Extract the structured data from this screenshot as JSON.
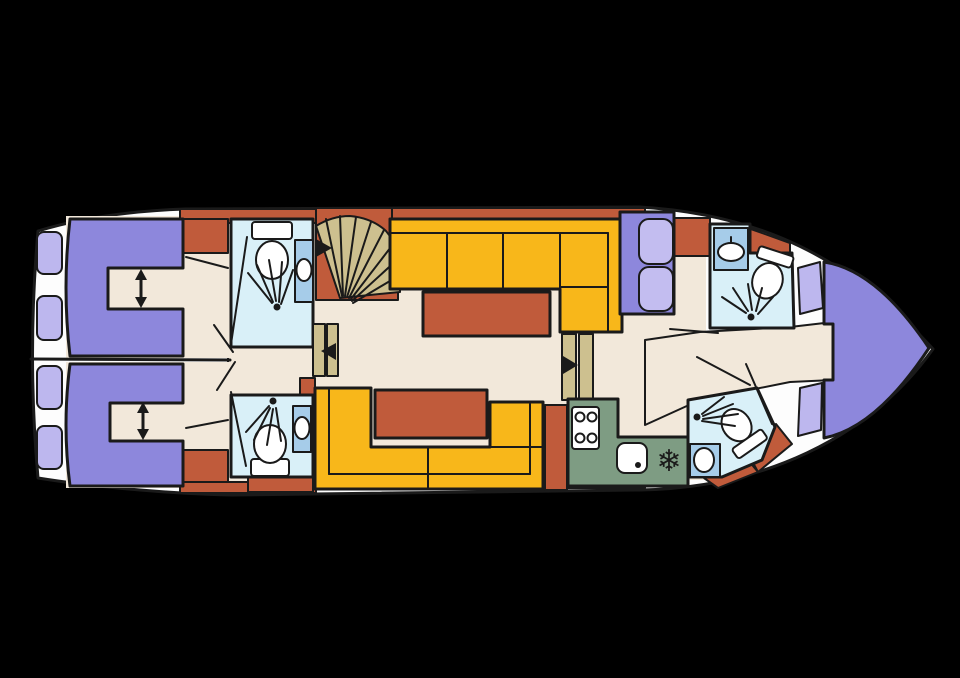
{
  "title": "yacht-deck-floor-plan",
  "colors": {
    "background": "#000000",
    "hull": "#fdfdfd",
    "outline": "#1a1a1a",
    "floor": "#f2e8da",
    "wall_cabinet": "#c05b3b",
    "sofa": "#f8b71a",
    "bed": "#8d87dc",
    "cushion": "#c3bdf0",
    "window": "#bdb7ee",
    "bathroom": "#d9f0f8",
    "sink_unit": "#a6cce9",
    "galley": "#7e9c83",
    "steps": "#cdc08f",
    "fixture": "#ffffff",
    "icon": "#1a1a1a"
  },
  "icons": {
    "freezer_glyph": "❄"
  },
  "features": [
    "aft-cabin-port",
    "aft-cabin-starboard",
    "aft-berth",
    "berth-length-arrow",
    "aft-head-port",
    "aft-head-starboard",
    "toilet",
    "shower-spray",
    "washbasin",
    "companionway-fan-stairs",
    "entry-arrow",
    "salon-l-sofa",
    "salon-table",
    "dinette-u-sofa",
    "dinette-table",
    "midship-steps",
    "galley",
    "stove-4-burner",
    "galley-sink",
    "freezer",
    "forward-head-port",
    "forward-head-starboard",
    "settee-cushions",
    "bow-v-berth",
    "hull-windows",
    "door-swing"
  ]
}
